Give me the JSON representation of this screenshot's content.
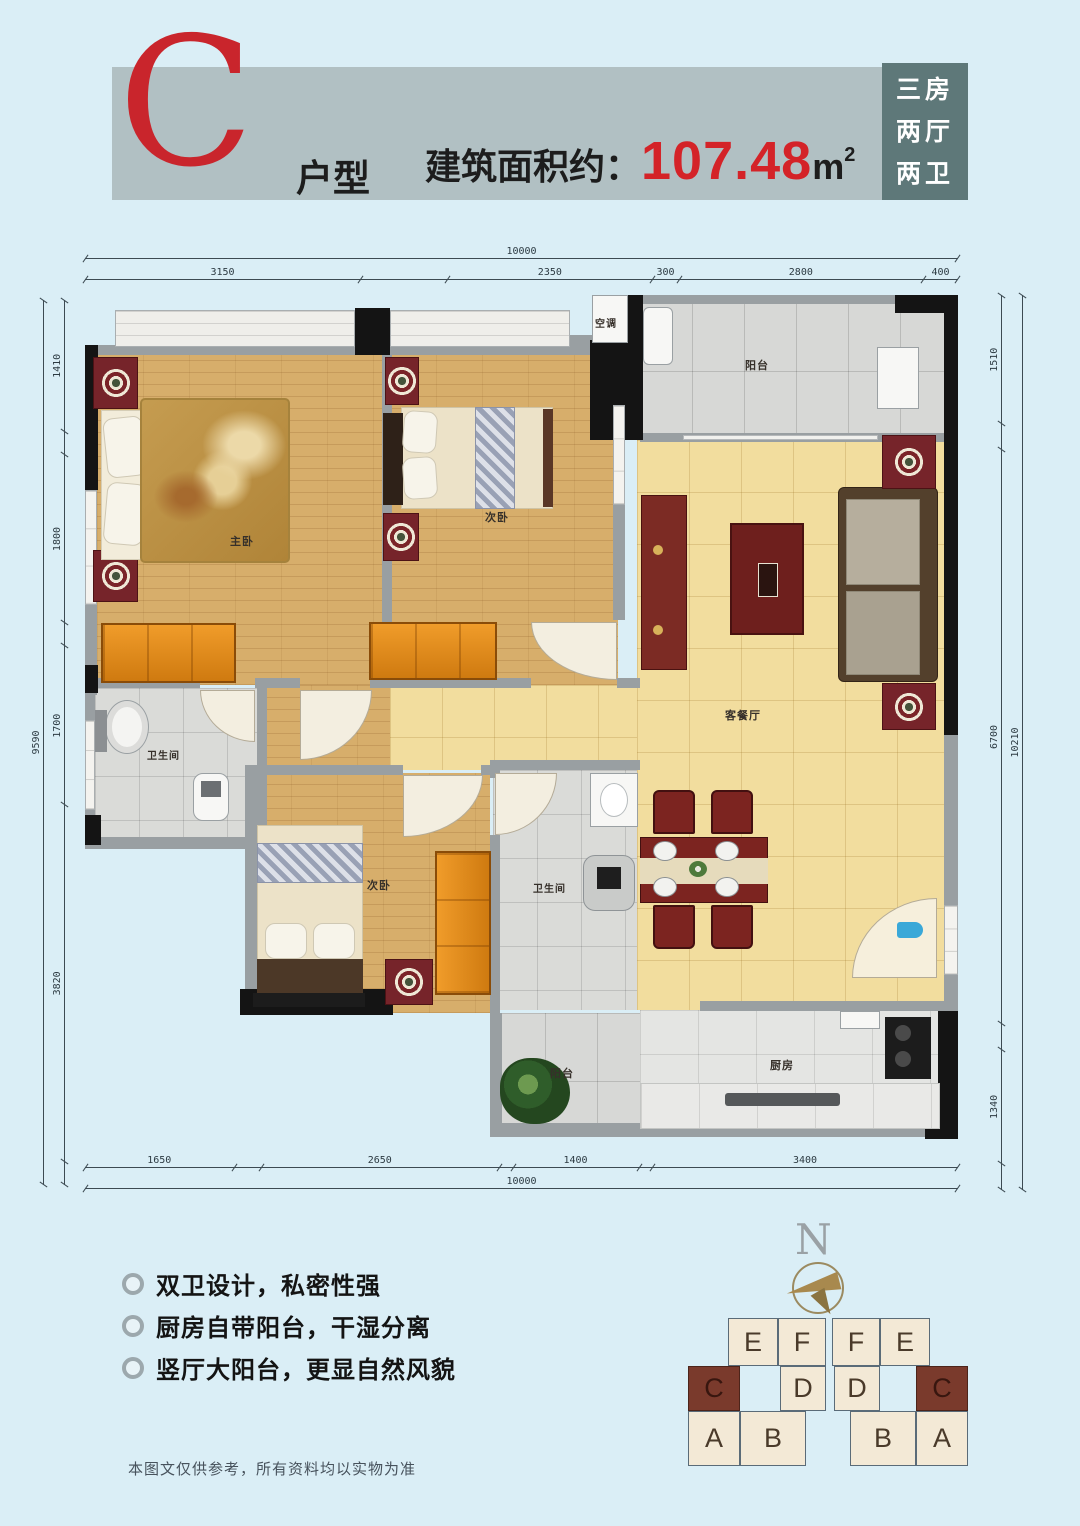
{
  "header": {
    "type_letter": "C",
    "type_suffix": "户型",
    "area_prefix": "建筑面积约：",
    "area_value": "107.48",
    "area_unit": "m",
    "area_sup": "2",
    "tag_lines": [
      "三房",
      "两厅",
      "两卫"
    ],
    "colors": {
      "bar": "#b1c0c3",
      "tag_bg": "#5e7879",
      "accent_red": "#d42328"
    }
  },
  "plan": {
    "labels": {
      "master": "主卧",
      "bed2": "次卧",
      "bed3": "次卧",
      "living": "客餐厅",
      "bath1": "卫生间",
      "bath2": "卫生间",
      "kitchen": "厨房",
      "balcony_top": "阳台",
      "balcony_bottom": "阳台",
      "ac": "空调"
    },
    "dimensions": {
      "top": {
        "total": "10000",
        "segments": [
          {
            "label": "3150",
            "v": 3150
          },
          {
            "label": "",
            "v": 1000
          },
          {
            "label": "2350",
            "v": 2350
          },
          {
            "label": "300",
            "v": 300
          },
          {
            "label": "2800",
            "v": 2800
          },
          {
            "label": "400",
            "v": 400
          }
        ]
      },
      "bottom": {
        "total": "10000",
        "segments": [
          {
            "label": "1650",
            "v": 1650
          },
          {
            "label": "",
            "v": 300
          },
          {
            "label": "2650",
            "v": 2650
          },
          {
            "label": "",
            "v": 150
          },
          {
            "label": "1400",
            "v": 1400
          },
          {
            "label": "",
            "v": 150
          },
          {
            "label": "3400",
            "v": 3400
          }
        ]
      },
      "left": {
        "total": "9590",
        "segments": [
          {
            "label": "",
            "v": 250
          },
          {
            "label": "3820",
            "v": 3820
          },
          {
            "label": "1700",
            "v": 1700
          },
          {
            "label": "",
            "v": 250
          },
          {
            "label": "1800",
            "v": 1800
          },
          {
            "label": "",
            "v": 250
          },
          {
            "label": "1410",
            "v": 1410
          }
        ]
      },
      "right": {
        "total": "10210",
        "segments": [
          {
            "label": "",
            "v": 300
          },
          {
            "label": "1340",
            "v": 1340
          },
          {
            "label": "",
            "v": 300
          },
          {
            "label": "6700",
            "v": 6700
          },
          {
            "label": "",
            "v": 300
          },
          {
            "label": "1510",
            "v": 1510
          }
        ]
      }
    }
  },
  "features": {
    "items": [
      "双卫设计，私密性强",
      "厨房自带阳台，干湿分离",
      "竖厅大阳台，更显自然风貌"
    ]
  },
  "compass": {
    "north_label": "N"
  },
  "building": {
    "cells": [
      {
        "label": "E",
        "highlight": false
      },
      {
        "label": "F",
        "highlight": false
      },
      {
        "label": "F",
        "highlight": false
      },
      {
        "label": "E",
        "highlight": false
      },
      {
        "label": "C",
        "highlight": true
      },
      {
        "label": "D",
        "highlight": false
      },
      {
        "label": "D",
        "highlight": false
      },
      {
        "label": "C",
        "highlight": true
      },
      {
        "label": "A",
        "highlight": false
      },
      {
        "label": "B",
        "highlight": false
      },
      {
        "label": "B",
        "highlight": false
      },
      {
        "label": "A",
        "highlight": false
      }
    ]
  },
  "disclaimer": "本图文仅供参考，所有资料均以实物为准"
}
